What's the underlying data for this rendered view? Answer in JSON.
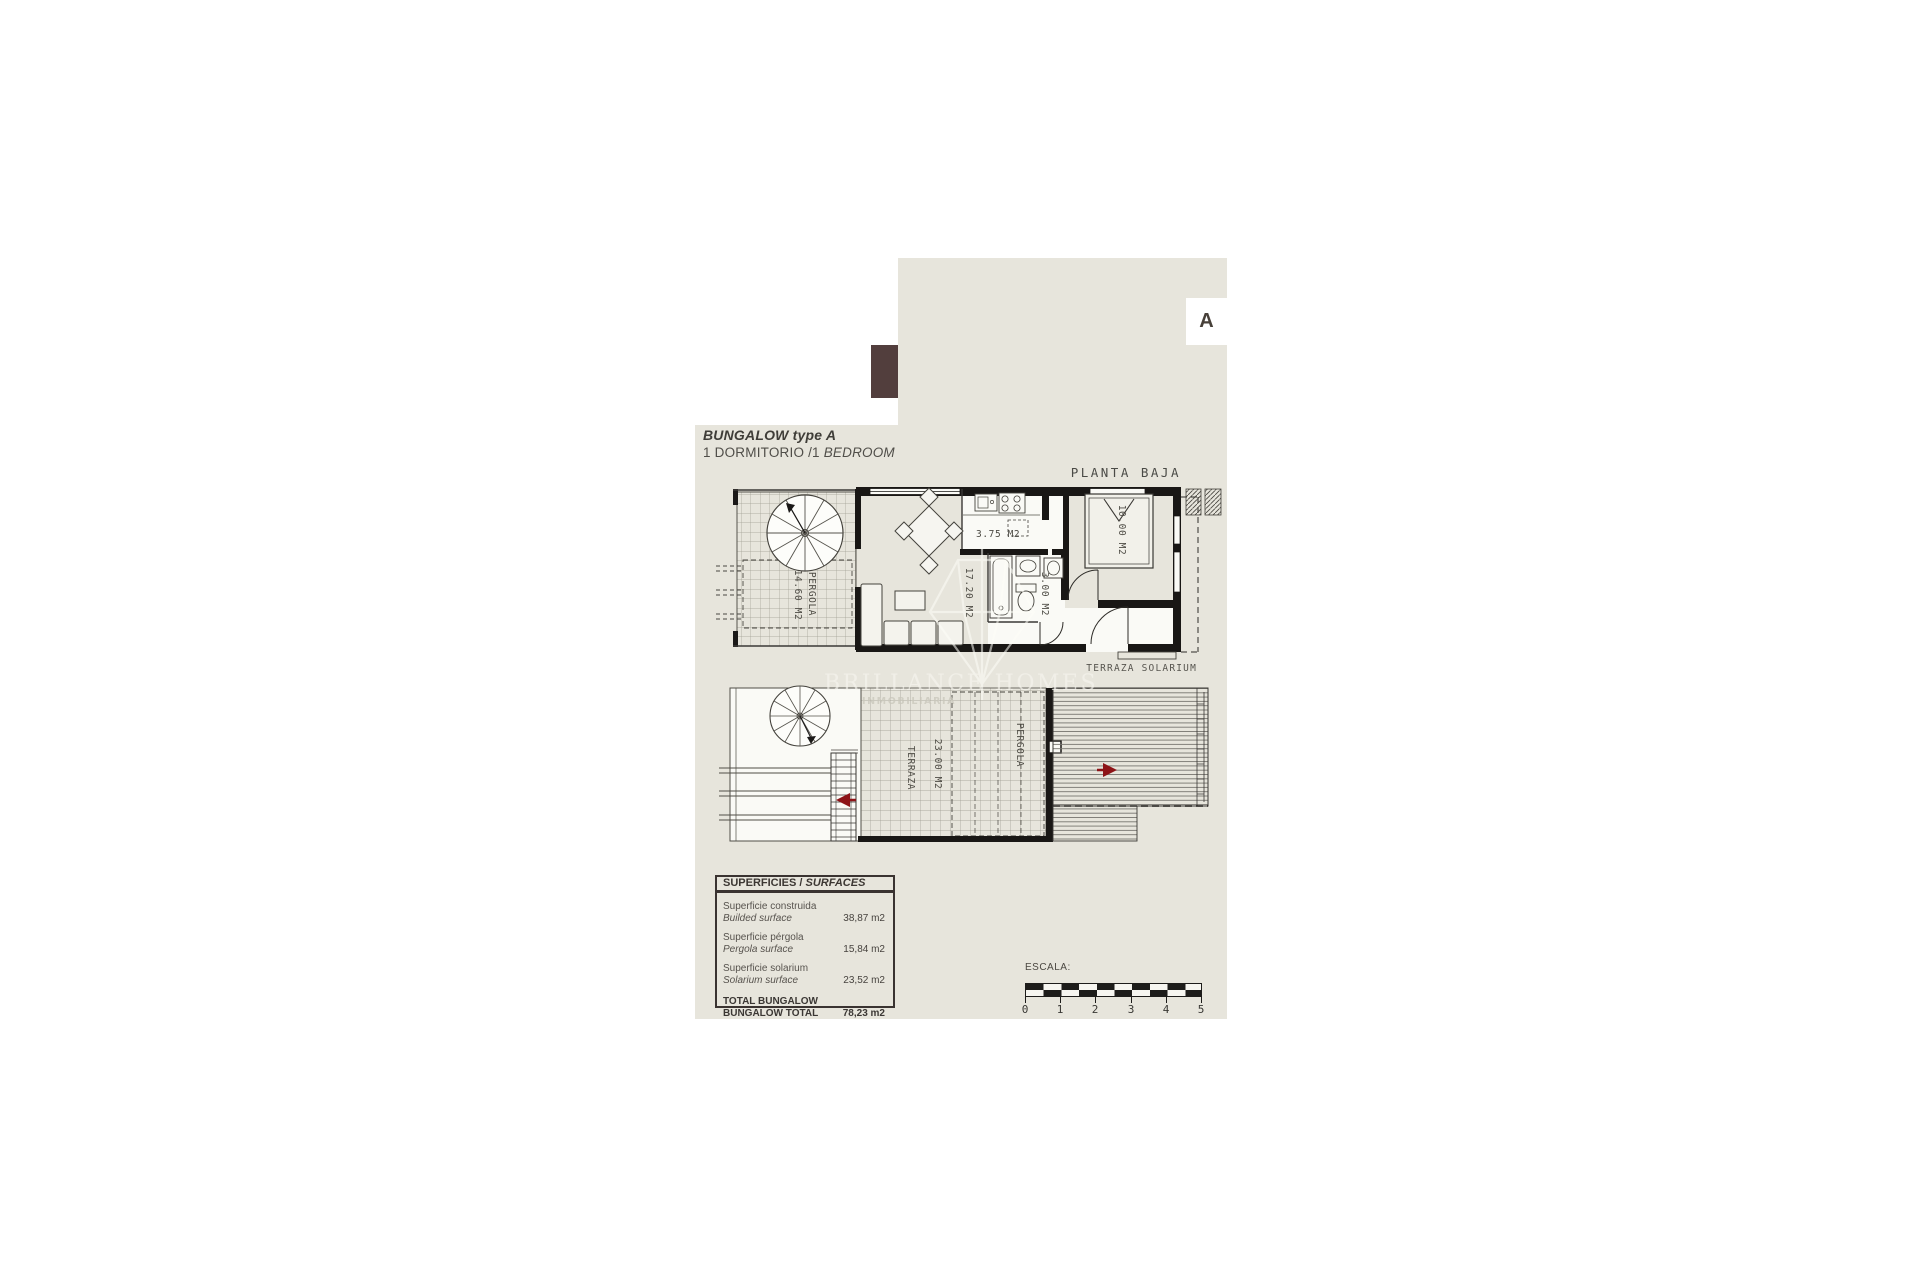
{
  "colors": {
    "panel": "#e7e5dc",
    "accent_block": "#523e3d",
    "arrow_red": "#8d1317"
  },
  "header": {
    "badge": "A",
    "title": "BUNGALOW type A",
    "subtitle_prefix": "1 DORMITORIO /1 ",
    "subtitle_italic": "BEDROOM"
  },
  "ground_plan": {
    "caption": "PLANTA BAJA",
    "pergola_name": "PERGOLA",
    "pergola_area": "14.60 M2",
    "living_area": "17.20 M2",
    "kitchen_area": "3.75 M2",
    "bath_area": "3.00 M2",
    "bedroom_area": "10.00 M2"
  },
  "upper_plan": {
    "caption": "TERRAZA SOLARIUM",
    "terrace_name": "TERRAZA",
    "terrace_area": "23.00 M2",
    "pergola_name": "PERGOLA"
  },
  "watermark": {
    "name": "BRILLANCE HOMES",
    "tagline": "INMOBILIARIA"
  },
  "surfaces": {
    "title_prefix": "SUPERFICIES /",
    "title_italic": " SURFACES",
    "rows": [
      {
        "label_es": "Superficie construida",
        "label_en": "Builded surface",
        "value": "38,87 m2"
      },
      {
        "label_es": "Superficie pérgola",
        "label_en": "Pergola surface",
        "value": "15,84 m2"
      },
      {
        "label_es": "Superficie solarium",
        "label_en": "Solarium surface",
        "value": "23,52 m2"
      }
    ],
    "total": {
      "label_es": "TOTAL BUNGALOW",
      "label_en": "BUNGALOW TOTAL",
      "value": "78,23 m2"
    }
  },
  "scale": {
    "label": "ESCALA:",
    "ticks": [
      "0",
      "1",
      "2",
      "3",
      "4",
      "5"
    ]
  }
}
